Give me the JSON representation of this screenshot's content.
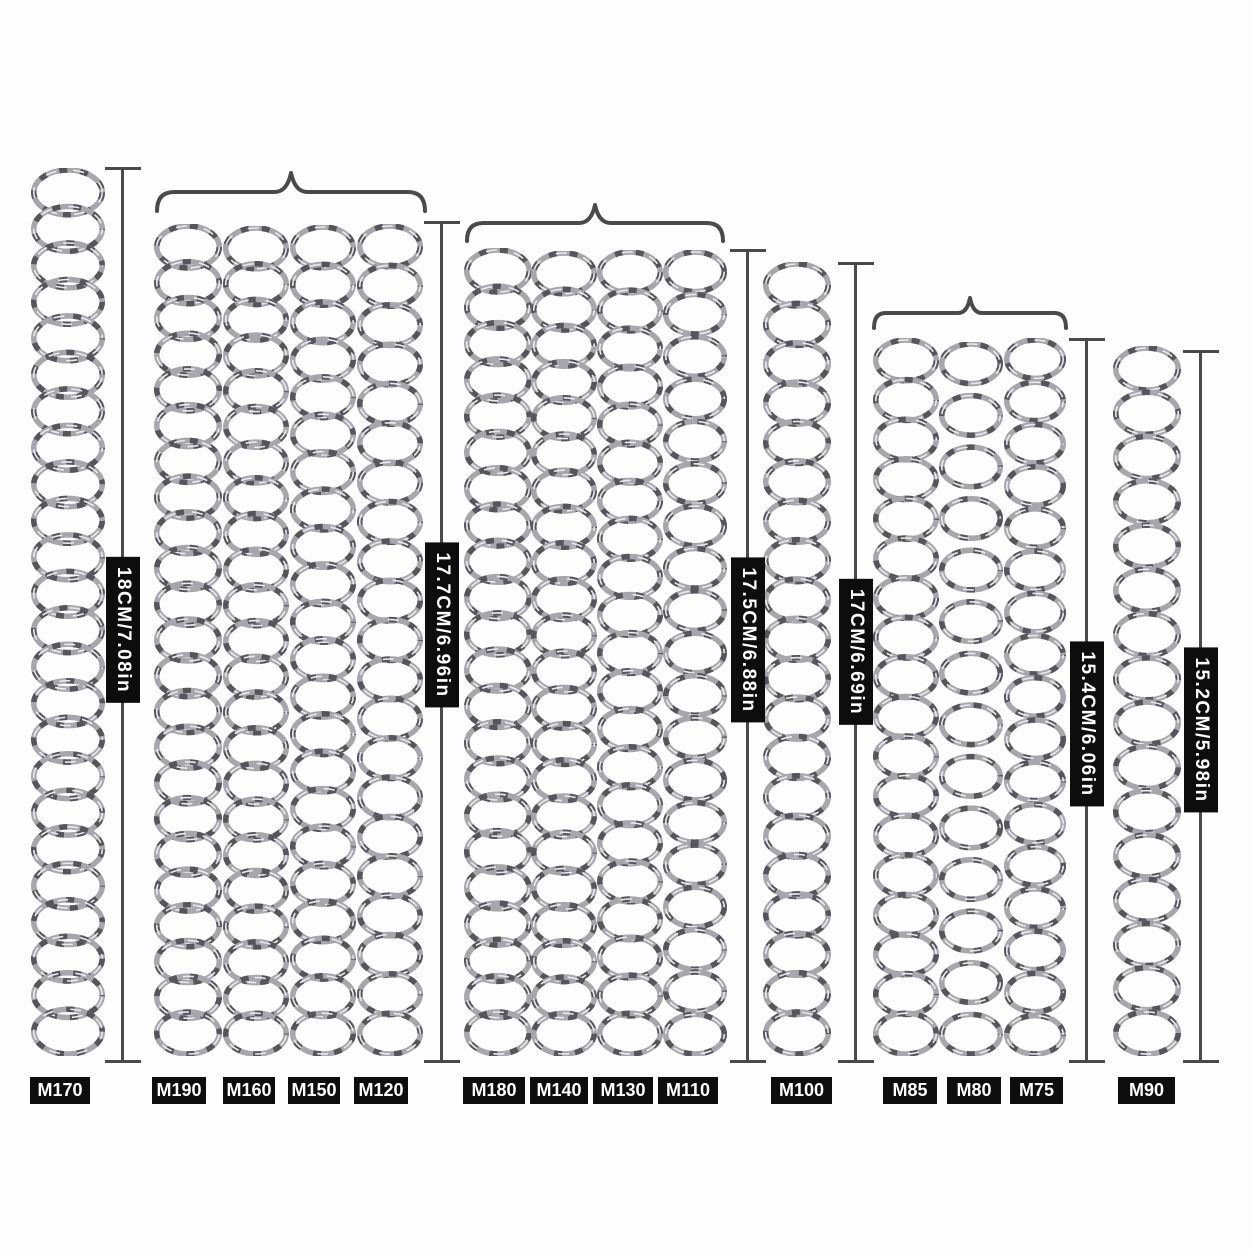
{
  "diagram_title": "spring-length-comparison",
  "groups": [
    {
      "measurement": "18CM/7.08in",
      "models": [
        "M170"
      ]
    },
    {
      "measurement": "17.7CM/6.96in",
      "models": [
        "M190",
        "M160",
        "M150",
        "M120"
      ]
    },
    {
      "measurement": "17.5CM/6.88in",
      "models": [
        "M180",
        "M140",
        "M130",
        "M110"
      ]
    },
    {
      "measurement": "17CM/6.69in",
      "models": [
        "M100"
      ]
    },
    {
      "measurement": "15.4CM/6.06in",
      "models": [
        "M85",
        "M80",
        "M75"
      ]
    },
    {
      "measurement": "15.2CM/5.98in",
      "models": [
        "M90"
      ]
    }
  ],
  "colors": {
    "label_background": "#0d0d0d",
    "label_text": "#ffffff",
    "measure_line": "#4a4a4a",
    "brace": "#4a4a4a",
    "spring_base": "#a6a6ac",
    "spring_shadow": "#55555c",
    "spring_highlight": "#eaeaee",
    "background": "#fdfdfd"
  }
}
